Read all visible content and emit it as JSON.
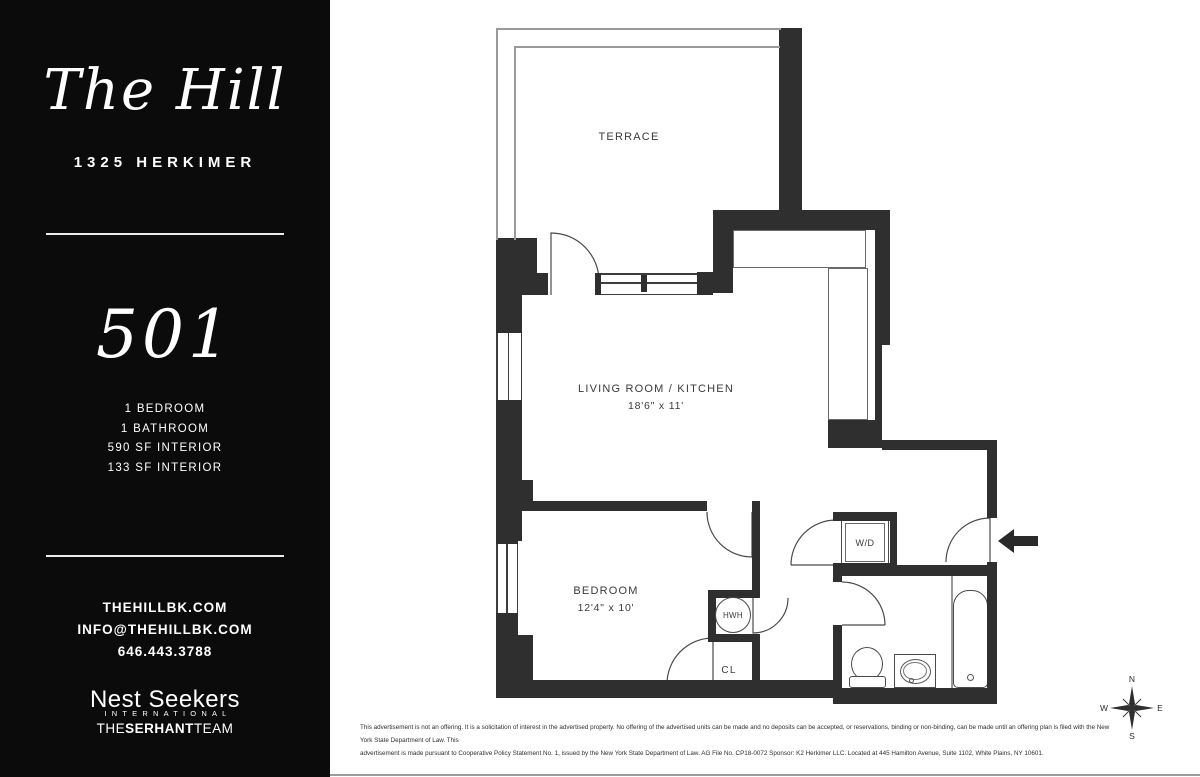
{
  "sidebar": {
    "building_name": "The Hill",
    "address": "1325 HERKIMER",
    "unit_number": "501",
    "details": [
      "1 BEDROOM",
      "1 BATHROOM",
      "590 SF INTERIOR",
      "133 SF INTERIOR"
    ],
    "contact": {
      "website": "THEHILLBK.COM",
      "email": "INFO@THEHILLBK.COM",
      "phone": "646.443.3788"
    },
    "brokerage": {
      "name": "Nest Seekers",
      "subtitle": "INTERNATIONAL",
      "team_prefix": "THE",
      "team_bold": "SERHANT",
      "team_suffix": "TEAM"
    }
  },
  "floorplan": {
    "rooms": {
      "terrace": {
        "label": "TERRACE"
      },
      "living": {
        "label": "LIVING ROOM / KITCHEN",
        "dims": "18'6\" x 11'"
      },
      "bedroom": {
        "label": "BEDROOM",
        "dims": "12'4\" x 10'"
      }
    },
    "fixtures": {
      "dishwasher": "DW",
      "washer_dryer": "W/D",
      "water_heater": "HWH",
      "closet": "CL"
    }
  },
  "compass": {
    "north": "N",
    "east": "E",
    "south": "S",
    "west": "W"
  },
  "disclaimer": {
    "line1": "This advertisement is not an offering. It is a solicitation of interest in the advertised property. No offering of the advertised units can be made and no deposits can be accepted, or reservations, binding or non-binding, can be made until an offering plan is filed with the New York State Department of Law. This",
    "line2": "advertisement is made pursuant to Cooperative Policy Statement No. 1, issued by the New York State Department of Law. AG File No. CP18-0072 Sponsor: K2 Herkimer LLC. Located at 445 Hamilton Avenue, Suite 1102, White Plains, NY 10601."
  },
  "colors": {
    "sidebar_bg": "#0b0b0b",
    "sidebar_text": "#ffffff",
    "wall": "#2f2f2f",
    "parapet_line": "#9a9a9a",
    "label_text": "#3a3a3a",
    "background": "#ffffff"
  }
}
